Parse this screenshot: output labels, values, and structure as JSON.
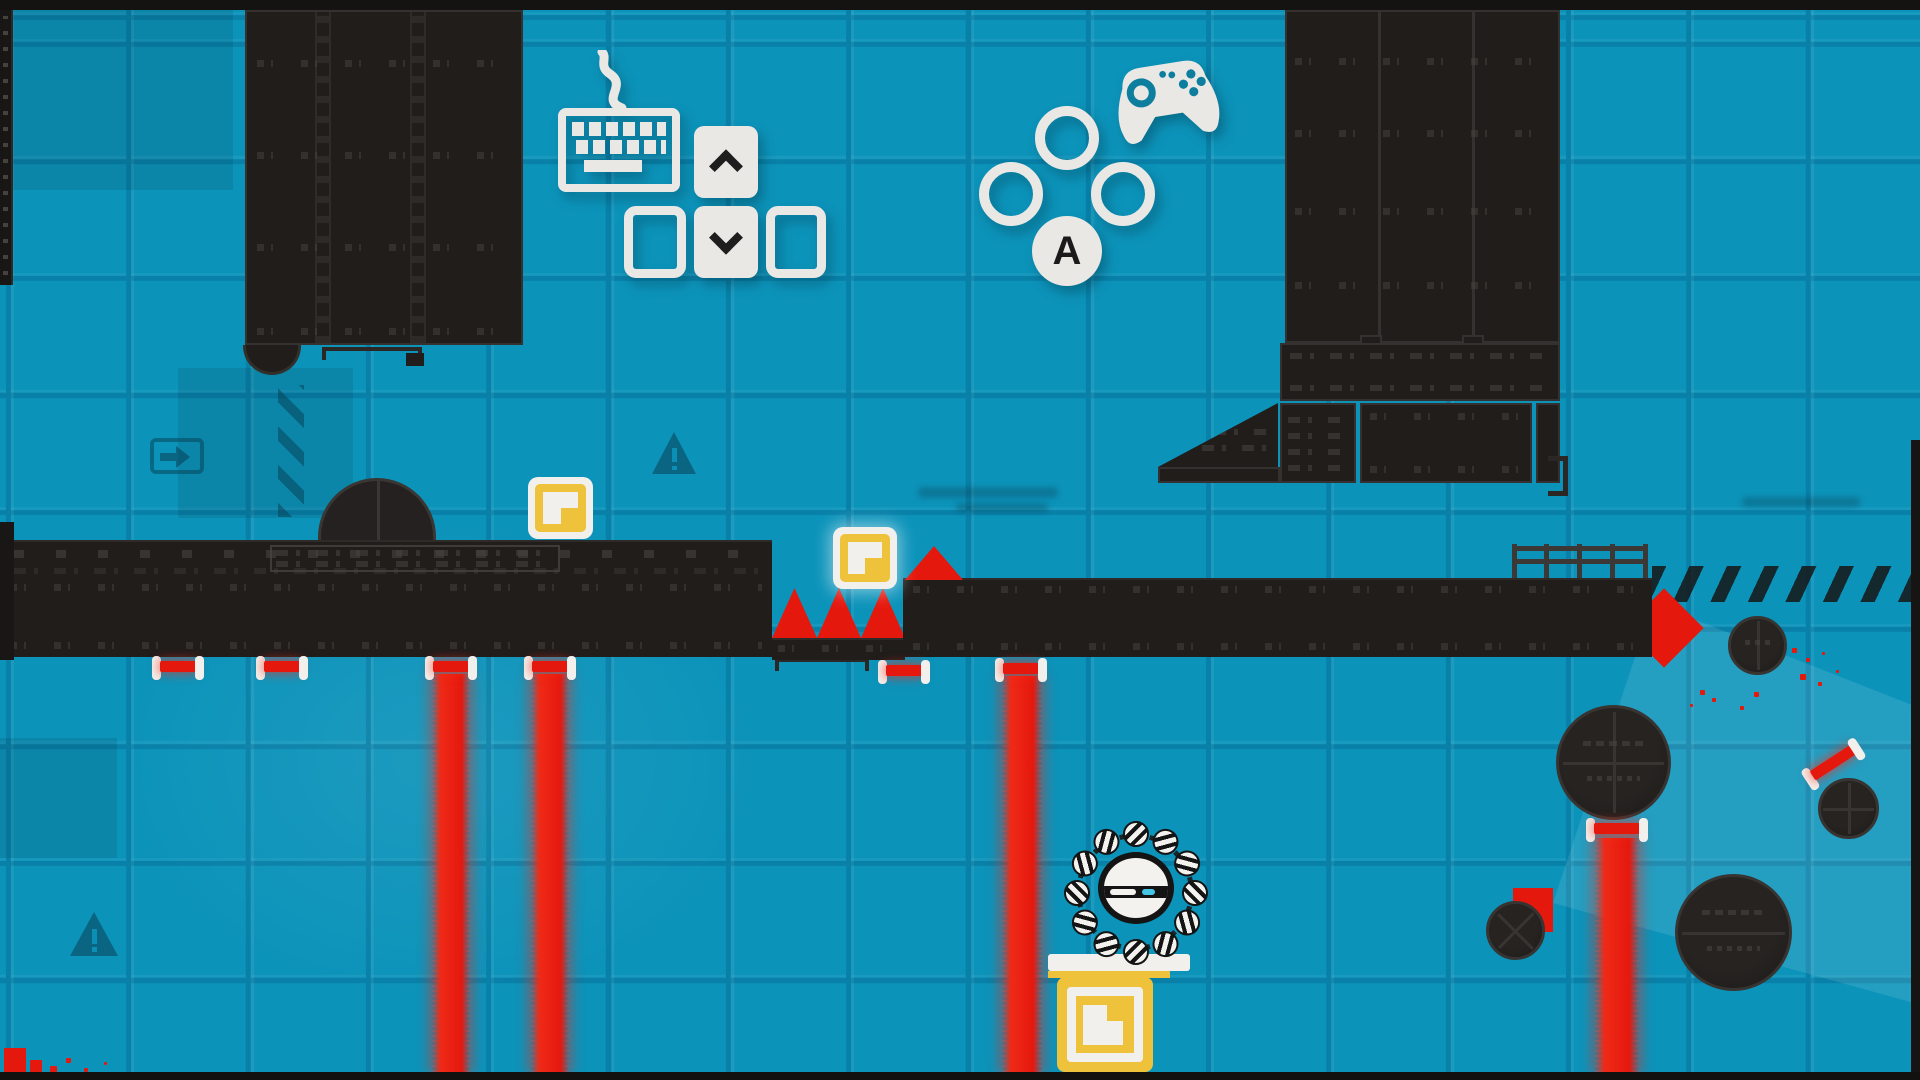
{
  "hud": {
    "keyboard_hint": {
      "icon": "keyboard-icon",
      "keys": [
        {
          "name": "up-arrow-key",
          "glyph": "chevron-up",
          "style": "solid"
        },
        {
          "name": "left-arrow-key",
          "glyph": "",
          "style": "outline"
        },
        {
          "name": "down-arrow-key",
          "glyph": "chevron-down",
          "style": "solid"
        },
        {
          "name": "right-arrow-key",
          "glyph": "",
          "style": "outline"
        }
      ]
    },
    "gamepad_hint": {
      "icon": "gamepad-icon",
      "buttons": [
        {
          "name": "top-face-button",
          "style": "outline",
          "label": ""
        },
        {
          "name": "left-face-button",
          "style": "outline",
          "label": ""
        },
        {
          "name": "right-face-button",
          "style": "outline",
          "label": ""
        },
        {
          "name": "a-face-button",
          "style": "solid",
          "label": "A"
        }
      ]
    }
  },
  "level": {
    "player": {
      "name": "wheel-character",
      "ring_balls": 12,
      "body": "white-core-with-band"
    },
    "hazards": {
      "vertical_laser_beams": 4,
      "idle_laser_emitters": 5,
      "angled_laser_emitter": 1,
      "small_spikes": 3,
      "large_spike": 1,
      "saw_wheels": 5,
      "red_diamond_arrow": 1
    },
    "pickups": {
      "floating_yellow_boxes": 2,
      "yellow_crate": 1
    },
    "props": {
      "dome_bunker": 1,
      "railing": 1,
      "warning_triangles": 2,
      "arrow_sign": 1,
      "hazard_stripe_bands": 2
    }
  },
  "colors": {
    "bg": "#0C93BA",
    "grid": "#0880A8",
    "ink": "#201D1B",
    "ink_mark": "#47433F",
    "red": "#E5180E",
    "yellow": "#EFC23C",
    "white": "#F2F0EC",
    "cyan": "#45C6E6"
  }
}
